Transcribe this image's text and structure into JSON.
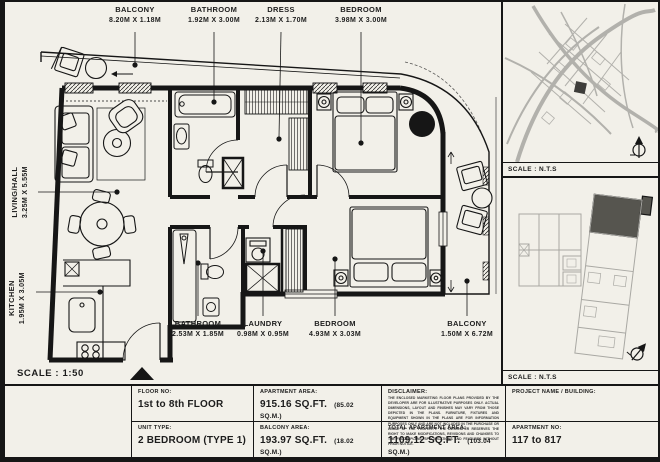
{
  "plan": {
    "scale_label": "SCALE : 1:50",
    "rooms": {
      "balcony_top": {
        "name": "BALCONY",
        "dims": "8.20M X 1.18M"
      },
      "bathroom_top": {
        "name": "BATHROOM",
        "dims": "1.92M X 3.00M"
      },
      "dress": {
        "name": "DRESS",
        "dims": "2.13M X 1.70M"
      },
      "bedroom_top": {
        "name": "BEDROOM",
        "dims": "3.98M X 3.00M"
      },
      "living": {
        "name": "LIVING/HALL",
        "dims": "3.25M X 5.55M"
      },
      "kitchen": {
        "name": "KITCHEN",
        "dims": "1.95M X 3.05M"
      },
      "bathroom_bottom": {
        "name": "BATHROOM",
        "dims": "2.53M X 1.85M"
      },
      "laundry": {
        "name": "LAUNDRY",
        "dims": "0.98M X 0.95M"
      },
      "bedroom_bottom": {
        "name": "BEDROOM",
        "dims": "4.93M X 3.03M"
      },
      "balcony_right": {
        "name": "BALCONY",
        "dims": "1.50M X 6.72M"
      }
    }
  },
  "panels": {
    "location_map": {
      "scale_label": "SCALE : N.T.S"
    },
    "key_plan": {
      "scale_label": "SCALE : N.T.S"
    }
  },
  "table": {
    "floor": {
      "label": "FLOOR NO:",
      "value": "1st to 8th FLOOR"
    },
    "unit_type": {
      "label": "UNIT TYPE:",
      "value": "2 BEDROOM (TYPE 1)"
    },
    "apartment_area": {
      "label": "APARTMENT AREA:",
      "value": "915.16 SQ.FT.",
      "metric": "(85.02 SQ.M.)"
    },
    "balcony_area": {
      "label": "BALCONY AREA:",
      "value": "193.97 SQ.FT.",
      "metric": "(18.02 SQ.M.)"
    },
    "total_area": {
      "label": "TOTAL APARTMENT AREA:",
      "value": "1109.12 SQ.FT.",
      "metric": "(103.04 SQ.M.)"
    },
    "disclaimer": {
      "label": "DISCLAIMER:",
      "text": "THE ENCLOSED MARKETING FLOOR PLANS PROVIDED BY THE DEVELOPER ARE FOR ILLUSTRATIVE PURPOSES ONLY. ACTUAL DIMENSIONS, LAYOUT AND FINISHES MAY VARY FROM THOSE DEPICTED IN THE PLANS. FURNITURE, FIXTURES AND EQUIPMENT SHOWN IN THE PLANS ARE FOR INFORMATION PURPOSES ONLY AND ARE NOT INCLUDED IN THE PURCHASE OR LEASE OF THE PROPERTY. THE DEVELOPER RESERVES THE RIGHT TO MAKE MODIFICATIONS, REVISIONS AND CHANGES TO THE FLOOR PLANS, SPECIFICATIONS AND FEATURES WITHOUT PRIOR NOTICE."
    },
    "project": {
      "label": "PROJECT NAME / BUILDING:",
      "value": ""
    },
    "apartment_no": {
      "label": "APARTMENT NO:",
      "value": "117 to 817"
    }
  },
  "colors": {
    "ink": "#161616",
    "paper": "#f2f0e9",
    "map_gray": "#b2b1ac",
    "highlight": "#56554f"
  }
}
